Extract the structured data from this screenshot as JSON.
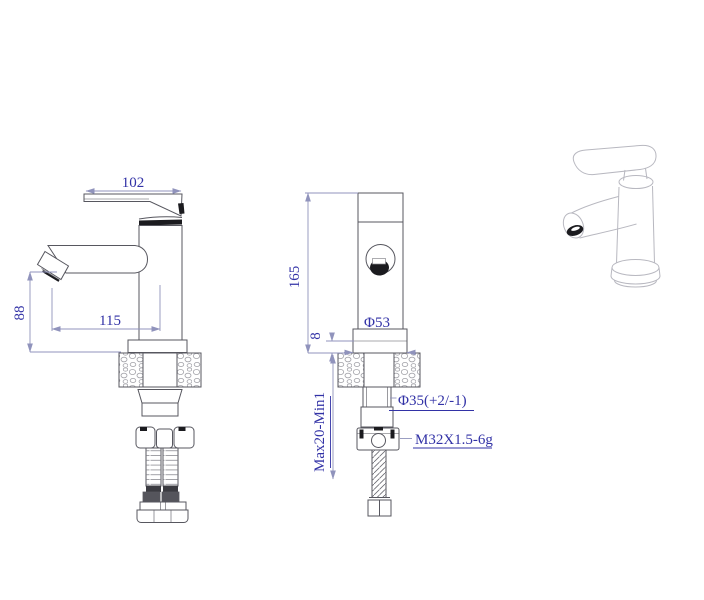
{
  "labels": {
    "side": {
      "handle_width": "102",
      "spout_reach": "115",
      "spout_height": "88"
    },
    "front": {
      "overall_height": "165",
      "base_height": "8",
      "base_diameter": "Φ53",
      "shank_diameter": "Φ35(+2/-1)",
      "mounting_range": "Max20-Min1",
      "thread_spec": "M32X1.5-6g"
    }
  },
  "colors": {
    "background": "#ffffff",
    "outline": "#57575f",
    "dark_fill": "#1b1b1f",
    "dimension_line": "#9093bc",
    "dimension_text": "#3232a6",
    "light_outline": "#b8b8c0",
    "hatch": "#a2a2a8"
  }
}
